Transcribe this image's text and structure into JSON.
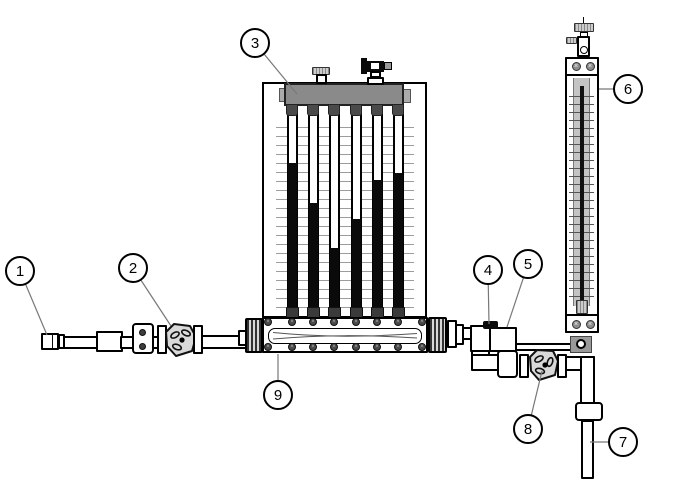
{
  "diagram_type": "flow-measurement-apparatus-diagram",
  "colors": {
    "background": "#ffffff",
    "line": "#000000",
    "leader": "#787878",
    "manifold_gray": "#8a8a8a",
    "connector_dark": "#4a4a4a",
    "grid_line": "#9c9c9c",
    "fluid_black": "#0a0a0a",
    "valve_body_gray": "#d9d9d9",
    "port_gray": "#9a9a9a",
    "scale_track_gray": "#c4c4c4"
  },
  "callouts": [
    {
      "num": "1",
      "target": "supply-hose-connector",
      "cx": 20,
      "cy": 271,
      "tx": 47,
      "ty": 335
    },
    {
      "num": "2",
      "target": "inlet-control-valve",
      "cx": 133,
      "cy": 268,
      "tx": 171,
      "ty": 326
    },
    {
      "num": "3",
      "target": "manometer-manifold",
      "cx": 255,
      "cy": 43,
      "tx": 297,
      "ty": 94
    },
    {
      "num": "4",
      "target": "discharge-tee-plug",
      "cx": 488,
      "cy": 270,
      "tx": 489,
      "ty": 324
    },
    {
      "num": "5",
      "target": "tee-to-flowmeter-pipe",
      "cx": 528,
      "cy": 264,
      "tx": 507,
      "ty": 327
    },
    {
      "num": "6",
      "target": "flowmeter-tube",
      "cx": 628,
      "cy": 89,
      "tx": 599,
      "ty": 89
    },
    {
      "num": "7",
      "target": "outlet-pipe",
      "cx": 623,
      "cy": 442,
      "tx": 590,
      "ty": 442
    },
    {
      "num": "8",
      "target": "discharge-control-valve",
      "cx": 528,
      "cy": 429,
      "tx": 542,
      "ty": 371
    },
    {
      "num": "9",
      "target": "venturi-test-section",
      "cx": 278,
      "cy": 395,
      "tx": 278,
      "ty": 354
    }
  ],
  "manometer": {
    "tube_count": 6,
    "tube_centers_x": [
      292,
      313,
      334,
      356,
      377,
      398
    ],
    "tube_top_y": 108,
    "column_top_y": [
      163,
      203,
      248,
      219,
      180,
      173
    ],
    "column_bottom_y": 317,
    "collar_top_y": 307
  },
  "fasteners": {
    "screw_glyph": "×",
    "x_screws": [
      [
        576,
        66
      ],
      [
        590,
        66
      ],
      [
        576,
        324
      ],
      [
        590,
        324
      ]
    ],
    "clamp_bolts": [
      [
        142,
        332
      ],
      [
        142,
        346
      ],
      [
        507,
        358
      ],
      [
        507,
        370
      ],
      [
        583,
        411
      ],
      [
        595,
        411
      ]
    ],
    "flange_bolt_xs": [
      268,
      292,
      313,
      334,
      356,
      377,
      398,
      422
    ],
    "flange_bolt_ys": [
      322,
      347
    ]
  },
  "flowmeter": {
    "float_top_y": 86,
    "float_bottom_y": 300
  }
}
